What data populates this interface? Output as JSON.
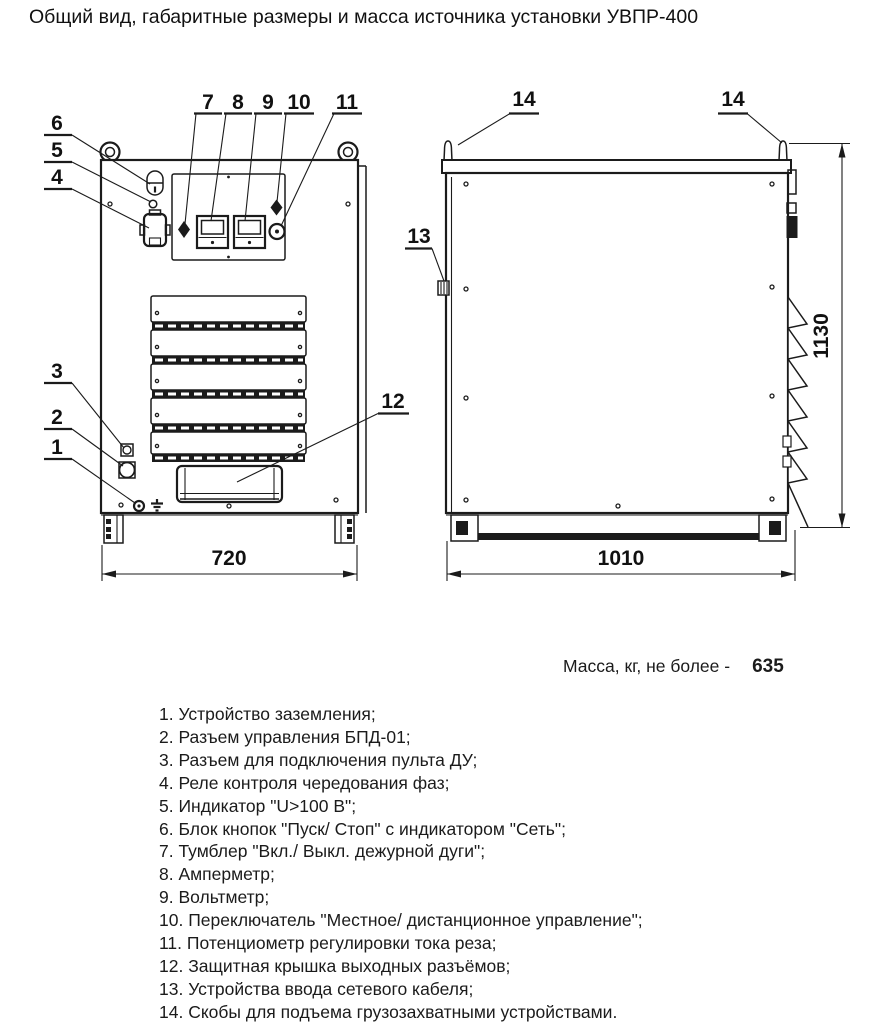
{
  "title": "Общий вид, габаритные размеры и масса источника установки УВПР-400",
  "front_view": {
    "dim_width": "720",
    "callouts": {
      "c1": "1",
      "c2": "2",
      "c3": "3",
      "c4": "4",
      "c5": "5",
      "c6": "6",
      "c7": "7",
      "c8": "8",
      "c9": "9",
      "c10": "10",
      "c11": "11",
      "c12": "12"
    }
  },
  "side_view": {
    "dim_width": "1010",
    "dim_height": "1130",
    "callouts": {
      "c13": "13",
      "c14_left": "14",
      "c14_right": "14"
    }
  },
  "mass": {
    "label": "Масса, кг, не более -",
    "value": "635"
  },
  "legend": {
    "items": [
      "1. Устройство заземления;",
      "2. Разъем управления БПД-01;",
      "3. Разъем для подключения пульта ДУ;",
      "4. Реле контроля чередования фаз;",
      "5. Индикатор \"U>100 В\";",
      "6. Блок кнопок \"Пуск/ Стоп\" с индикатором \"Сеть\";",
      "7. Тумблер \"Вкл./ Выкл. дежурной дуги\";",
      "8. Амперметр;",
      "9. Вольтметр;",
      "10. Переключатель \"Местное/ дистанционное управление\";",
      "11. Потенциометр регулировки тока реза;",
      "12. Защитная крышка выходных разъёмов;",
      "13. Устройства ввода сетевого кабеля;",
      "14. Скобы для подъема грузозахватными устройствами."
    ]
  }
}
